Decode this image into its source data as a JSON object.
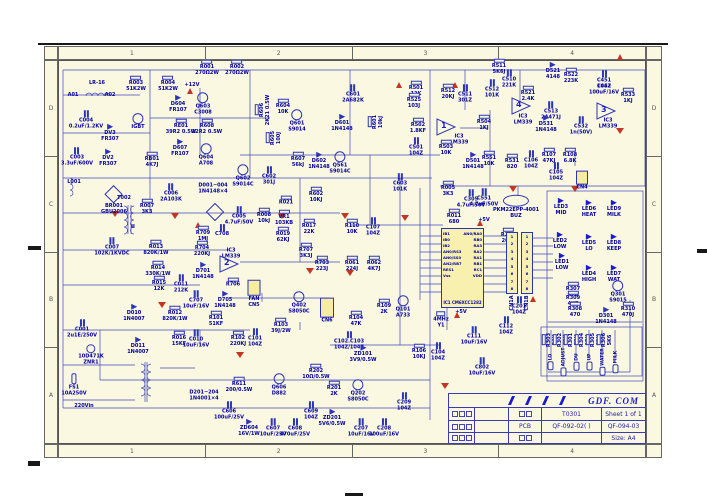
{
  "colors": {
    "paper": "#fbf8e1",
    "wire": "#2b35b8",
    "label": "#0000a0",
    "red": "#c43524",
    "ic_fill": "#f8f0ae"
  },
  "border": {
    "cols": [
      "1",
      "2",
      "3",
      "4"
    ],
    "rows": [
      "D",
      "C",
      "B",
      "A"
    ]
  },
  "title_block": {
    "company": "GDF. COM",
    "doc": "T0301",
    "sheet": "Sheet 1 of 1",
    "pcb": "PCB",
    "code1": "QF-092-02(  )",
    "code2": "QF-094-03",
    "size": "Size:  A4"
  },
  "ic1": {
    "ref": "IC1",
    "part": "CM6XCC1282",
    "left": [
      "IB1",
      "IB0",
      "IB2",
      "AN0/RS3",
      "AN0/SS0",
      "AN2/RB7",
      "RES1",
      "Vss"
    ],
    "right": [
      "AN0/RA0",
      "RB0",
      "RA3",
      "RA2",
      "RA1",
      "RB1",
      "RC1",
      "VDD"
    ]
  },
  "cn1": {
    "a": "CN1A",
    "b": "CN1B",
    "pins": [
      "1",
      "2",
      "3",
      "4",
      "5",
      "6",
      "7",
      "8"
    ]
  },
  "comparators": [
    {
      "n": "1",
      "x": 446,
      "y": 129
    },
    {
      "n": "4",
      "x": 521,
      "y": 108
    },
    {
      "n": "3",
      "x": 606,
      "y": 113
    },
    {
      "n": "2",
      "x": 229,
      "y": 266
    }
  ],
  "buttons": [
    {
      "label": "LO",
      "x": 551
    },
    {
      "label": "ADJUST",
      "x": 564
    },
    {
      "label": "DU",
      "x": 577
    },
    {
      "label": "UP",
      "x": 590
    },
    {
      "label": "WATER",
      "x": 603
    },
    {
      "label": "MILK",
      "x": 616
    }
  ],
  "buttons_y": 362,
  "grounds": [
    [
      115,
      211
    ],
    [
      175,
      213
    ],
    [
      345,
      213
    ],
    [
      405,
      215
    ],
    [
      513,
      186
    ],
    [
      575,
      186
    ],
    [
      620,
      128
    ],
    [
      350,
      270
    ],
    [
      162,
      302
    ],
    [
      240,
      352
    ],
    [
      310,
      268
    ],
    [
      445,
      383
    ],
    [
      282,
      213
    ]
  ],
  "powers": [
    [
      190,
      94
    ],
    [
      399,
      88
    ],
    [
      455,
      88
    ],
    [
      620,
      60
    ],
    [
      480,
      226
    ],
    [
      457,
      318
    ],
    [
      533,
      302
    ],
    [
      198,
      228
    ]
  ],
  "components": [
    {
      "r": "LR-16",
      "x": 97,
      "y": 84,
      "s": "txt"
    },
    {
      "r": "A01",
      "x": 73,
      "y": 96,
      "s": "txt"
    },
    {
      "r": "A02",
      "x": 110,
      "y": 96,
      "s": "txt"
    },
    {
      "r": "C004",
      "v": "0.2uF/1.2KV",
      "x": 86,
      "y": 120,
      "s": "cap"
    },
    {
      "r": "C003",
      "v": "3.3uF/600V",
      "x": 77,
      "y": 157,
      "s": "cap"
    },
    {
      "r": "IGBT",
      "x": 138,
      "y": 122,
      "s": "tr"
    },
    {
      "r": "DV3",
      "v": "FR307",
      "x": 110,
      "y": 133,
      "s": "dio"
    },
    {
      "r": "DV2",
      "v": "FR307",
      "x": 108,
      "y": 158,
      "s": "dio"
    },
    {
      "r": "RB01",
      "v": "4K7J",
      "x": 152,
      "y": 160,
      "s": "res"
    },
    {
      "r": "R003",
      "v": "51K2W",
      "x": 136,
      "y": 84,
      "s": "res"
    },
    {
      "r": "R004",
      "v": "51K2W",
      "x": 168,
      "y": 84,
      "s": "res"
    },
    {
      "r": "R001",
      "v": "270Ω2W",
      "x": 207,
      "y": 68,
      "s": "res"
    },
    {
      "r": "R002",
      "v": "270Ω2W",
      "x": 237,
      "y": 68,
      "s": "res"
    },
    {
      "r": "D604",
      "v": "FR107",
      "x": 178,
      "y": 104,
      "s": "dio"
    },
    {
      "r": "Q603",
      "v": "C3008",
      "x": 203,
      "y": 104,
      "s": "tr"
    },
    {
      "r": "RE01",
      "v": "39R2 0.5W",
      "x": 181,
      "y": 127,
      "s": "res"
    },
    {
      "r": "R608",
      "v": "22R2 0.5W",
      "x": 207,
      "y": 127,
      "s": "res"
    },
    {
      "r": "D607",
      "v": "FR107",
      "x": 180,
      "y": 148,
      "s": "dio"
    },
    {
      "r": "Q604",
      "v": "A708",
      "x": 206,
      "y": 155,
      "s": "tr"
    },
    {
      "r": "R606",
      "v": "2K21 0.5W",
      "x": 263,
      "y": 110,
      "s": "res",
      "rot": 1
    },
    {
      "r": "R605",
      "v": "100J",
      "x": 274,
      "y": 138,
      "s": "res",
      "rot": 1
    },
    {
      "r": "+12V",
      "x": 192,
      "y": 86,
      "s": "txt"
    },
    {
      "r": "Q602",
      "v": "S9014C",
      "x": 243,
      "y": 176,
      "s": "tr"
    },
    {
      "r": "C602",
      "v": "301J",
      "x": 269,
      "y": 176,
      "s": "cap"
    },
    {
      "r": "C601",
      "v": "2A682K",
      "x": 353,
      "y": 94,
      "s": "cap"
    },
    {
      "r": "R604",
      "v": "10K",
      "x": 283,
      "y": 107,
      "s": "res"
    },
    {
      "r": "Q601",
      "v": "S9014",
      "x": 297,
      "y": 121,
      "s": "tr"
    },
    {
      "r": "D601",
      "v": "1N4148",
      "x": 342,
      "y": 123,
      "s": "dio"
    },
    {
      "r": "R601",
      "v": "10kJ",
      "x": 376,
      "y": 122,
      "s": "res",
      "rot": 1
    },
    {
      "r": "R607",
      "v": "56kJ",
      "x": 298,
      "y": 160,
      "s": "res"
    },
    {
      "r": "D602",
      "v": "1N4148",
      "x": 319,
      "y": 161,
      "s": "dio"
    },
    {
      "r": "Q561",
      "v": "S9014C",
      "x": 340,
      "y": 163,
      "s": "tr"
    },
    {
      "r": "R501",
      "v": "12K",
      "x": 416,
      "y": 89,
      "s": "res"
    },
    {
      "r": "R525",
      "v": "103J",
      "x": 414,
      "y": 101,
      "s": "res"
    },
    {
      "r": "R512",
      "v": "20KJ",
      "x": 448,
      "y": 92,
      "s": "res"
    },
    {
      "r": "C511",
      "v": "301Z",
      "x": 465,
      "y": 94,
      "s": "cap"
    },
    {
      "r": "R502",
      "v": "1.8KF",
      "x": 418,
      "y": 126,
      "s": "res"
    },
    {
      "r": "IC3",
      "v": "LM339",
      "x": 459,
      "y": 140,
      "s": "txt"
    },
    {
      "r": "R504",
      "v": "1KJ",
      "x": 484,
      "y": 123,
      "s": "res"
    },
    {
      "r": "C501",
      "v": "104Z",
      "x": 416,
      "y": 147,
      "s": "cap"
    },
    {
      "r": "R503",
      "v": "10K",
      "x": 446,
      "y": 148,
      "s": "res"
    },
    {
      "r": "D501",
      "v": "1N4148",
      "x": 473,
      "y": 161,
      "s": "dio"
    },
    {
      "r": "R511",
      "v": "5K6J",
      "x": 499,
      "y": 67,
      "s": "res"
    },
    {
      "r": "C510",
      "v": "221K",
      "x": 509,
      "y": 79,
      "s": "cap"
    },
    {
      "r": "C512",
      "v": "101K",
      "x": 492,
      "y": 89,
      "s": "cap"
    },
    {
      "r": "D521",
      "v": "4148",
      "x": 553,
      "y": 71,
      "s": "dio"
    },
    {
      "r": "R522",
      "v": "223K",
      "x": 571,
      "y": 76,
      "s": "res"
    },
    {
      "r": "R521",
      "v": "2.4K",
      "x": 528,
      "y": 94,
      "s": "res"
    },
    {
      "r": "C451",
      "v": "104Z",
      "x": 604,
      "y": 80,
      "s": "cap"
    },
    {
      "r": "C452",
      "v": "100uF/16V",
      "x": 604,
      "y": 90,
      "s": "txt"
    },
    {
      "r": "R533",
      "v": "1KJ",
      "x": 628,
      "y": 96,
      "s": "res"
    },
    {
      "r": "IC3",
      "v": "LM339",
      "x": 523,
      "y": 120,
      "s": "txt"
    },
    {
      "r": "C513",
      "v": "2A471J",
      "x": 551,
      "y": 111,
      "s": "cap"
    },
    {
      "r": "D531",
      "v": "1N4148",
      "x": 546,
      "y": 124,
      "s": "dio"
    },
    {
      "r": "C532",
      "v": "1n(50V)",
      "x": 581,
      "y": 126,
      "s": "cap"
    },
    {
      "r": "IC3",
      "v": "LM339",
      "x": 608,
      "y": 124,
      "s": "txt"
    },
    {
      "r": "R551",
      "v": "10K",
      "x": 489,
      "y": 159,
      "s": "res"
    },
    {
      "r": "R531",
      "v": "820",
      "x": 512,
      "y": 162,
      "s": "res"
    },
    {
      "r": "C106",
      "v": "104Z",
      "x": 531,
      "y": 160,
      "s": "cap"
    },
    {
      "r": "R107",
      "v": "47KJ",
      "x": 549,
      "y": 156,
      "s": "res"
    },
    {
      "r": "R108",
      "v": "6.8K",
      "x": 570,
      "y": 156,
      "s": "res"
    },
    {
      "r": "C105",
      "v": "104Z",
      "x": 556,
      "y": 172,
      "s": "cap"
    },
    {
      "r": "CN4",
      "x": 582,
      "y": 181,
      "s": "con",
      "w": 12,
      "h": 14
    },
    {
      "r": "C551",
      "v": "4.7uF/50V",
      "x": 484,
      "y": 198,
      "s": "cap"
    },
    {
      "r": "PKM22EPP-4001",
      "v": "BUZ",
      "x": 516,
      "y": 207,
      "s": "buz"
    },
    {
      "r": "L001",
      "x": 74,
      "y": 183,
      "s": "txt"
    },
    {
      "r": "BR001",
      "v": "GBU2006",
      "x": 114,
      "y": 200,
      "s": "brg"
    },
    {
      "r": "T002",
      "x": 124,
      "y": 199,
      "s": "txt"
    },
    {
      "r": "II",
      "x": 133,
      "y": 228,
      "s": "txt"
    },
    {
      "r": "C006",
      "v": "2A103K",
      "x": 171,
      "y": 193,
      "s": "cap"
    },
    {
      "r": "R007",
      "v": "3K3",
      "x": 147,
      "y": 207,
      "s": "res"
    },
    {
      "r": "D001~004",
      "v": "1N4148×4",
      "x": 213,
      "y": 189,
      "s": "txt"
    },
    {
      "r": "",
      "x": 215,
      "y": 212,
      "s": "brg"
    },
    {
      "r": "C005",
      "v": "4.7uF/50V",
      "x": 239,
      "y": 216,
      "s": "cap"
    },
    {
      "r": "R008",
      "v": "10kJ",
      "x": 264,
      "y": 216,
      "s": "res"
    },
    {
      "r": "C007",
      "v": "102K/1KVDC",
      "x": 112,
      "y": 247,
      "s": "cap"
    },
    {
      "r": "R013",
      "v": "820K/1W",
      "x": 156,
      "y": 248,
      "s": "res"
    },
    {
      "r": "R014",
      "v": "330K/1W",
      "x": 158,
      "y": 269,
      "s": "res"
    },
    {
      "r": "R015",
      "v": "12K",
      "x": 159,
      "y": 284,
      "s": "res"
    },
    {
      "r": "R709",
      "v": "1MJ",
      "x": 203,
      "y": 234,
      "s": "res"
    },
    {
      "r": "R704",
      "v": "220KJ",
      "x": 202,
      "y": 249,
      "s": "res"
    },
    {
      "r": "C708",
      "x": 222,
      "y": 231,
      "s": "cap"
    },
    {
      "r": "IC3",
      "v": "LM339",
      "x": 231,
      "y": 254,
      "s": "txt"
    },
    {
      "r": "D701",
      "v": "1N4148",
      "x": 203,
      "y": 271,
      "s": "dio"
    },
    {
      "r": "C011",
      "v": "212K",
      "x": 181,
      "y": 284,
      "s": "cap"
    },
    {
      "r": "C707",
      "v": "10uF/16V",
      "x": 196,
      "y": 300,
      "s": "cap"
    },
    {
      "r": "D705",
      "v": "1N4148",
      "x": 225,
      "y": 300,
      "s": "dio"
    },
    {
      "r": "R706",
      "x": 233,
      "y": 283,
      "s": "res"
    },
    {
      "r": "R021",
      "x": 286,
      "y": 201,
      "s": "res"
    },
    {
      "r": "VR1",
      "v": "103KB",
      "x": 284,
      "y": 218,
      "s": "pot"
    },
    {
      "r": "R019",
      "v": "62KJ",
      "x": 283,
      "y": 235,
      "s": "res"
    },
    {
      "r": "R602",
      "v": "10KJ",
      "x": 316,
      "y": 195,
      "s": "res"
    },
    {
      "r": "R017",
      "v": "22K",
      "x": 309,
      "y": 227,
      "s": "res"
    },
    {
      "r": "R707",
      "v": "3K3J",
      "x": 306,
      "y": 251,
      "s": "res"
    },
    {
      "r": "R703",
      "v": "223J",
      "x": 322,
      "y": 264,
      "s": "res"
    },
    {
      "r": "R061",
      "v": "224J",
      "x": 352,
      "y": 264,
      "s": "res"
    },
    {
      "r": "R062",
      "v": "4K7J",
      "x": 374,
      "y": 264,
      "s": "res"
    },
    {
      "r": "R110",
      "v": "10K",
      "x": 352,
      "y": 227,
      "s": "res"
    },
    {
      "r": "C107",
      "v": "104Z",
      "x": 373,
      "y": 227,
      "s": "cap"
    },
    {
      "r": "C603",
      "v": "101K",
      "x": 400,
      "y": 183,
      "s": "cap"
    },
    {
      "r": "R005",
      "v": "3K3",
      "x": 448,
      "y": 189,
      "s": "res"
    },
    {
      "r": "R011",
      "v": "680",
      "x": 454,
      "y": 217,
      "s": "res"
    },
    {
      "r": "C305",
      "v": "4.7uF/50V",
      "x": 471,
      "y": 199,
      "s": "cap"
    },
    {
      "r": "R206",
      "v": "20KJ",
      "x": 508,
      "y": 236,
      "s": "res"
    },
    {
      "r": "4MHz",
      "v": "Y1",
      "x": 441,
      "y": 320,
      "s": "xtl"
    },
    {
      "r": "C111",
      "v": "10uF/16V",
      "x": 474,
      "y": 336,
      "s": "cap"
    },
    {
      "r": "C112",
      "v": "104Z",
      "x": 506,
      "y": 326,
      "s": "cap"
    },
    {
      "r": "C802",
      "v": "10uF/16V",
      "x": 482,
      "y": 367,
      "s": "cap"
    },
    {
      "r": "+5V",
      "x": 484,
      "y": 221,
      "s": "txt"
    },
    {
      "r": "+5V",
      "x": 461,
      "y": 313,
      "s": "txt"
    },
    {
      "r": "C001",
      "v": "2u1E/250V",
      "x": 82,
      "y": 329,
      "s": "cap"
    },
    {
      "r": "10D471K",
      "v": "ZNR1",
      "x": 91,
      "y": 355,
      "s": "zn2"
    },
    {
      "r": "FS1",
      "v": "10A250V",
      "x": 74,
      "y": 385,
      "s": "fus"
    },
    {
      "r": "220Vin",
      "x": 84,
      "y": 407,
      "s": "txt"
    },
    {
      "r": "D010",
      "v": "1N4007",
      "x": 134,
      "y": 313,
      "s": "dio"
    },
    {
      "r": "D011",
      "v": "1N4007",
      "x": 138,
      "y": 346,
      "s": "dio"
    },
    {
      "r": "R012",
      "v": "820K/1W",
      "x": 175,
      "y": 314,
      "s": "res"
    },
    {
      "r": "R016",
      "v": "15KF",
      "x": 179,
      "y": 339,
      "s": "res"
    },
    {
      "r": "C010",
      "v": "10uF/16V",
      "x": 196,
      "y": 339,
      "s": "cap"
    },
    {
      "r": "R101",
      "v": "51KF",
      "x": 216,
      "y": 319,
      "s": "res"
    },
    {
      "r": "R102",
      "v": "220KJ",
      "x": 238,
      "y": 339,
      "s": "res"
    },
    {
      "r": "C101",
      "v": "104Z",
      "x": 255,
      "y": 338,
      "s": "cap"
    },
    {
      "r": "FAN",
      "v": "CN5",
      "x": 254,
      "y": 294,
      "s": "con",
      "w": 13,
      "h": 16
    },
    {
      "r": "Q402",
      "v": "S8050C",
      "x": 299,
      "y": 303,
      "s": "tr"
    },
    {
      "r": "R103",
      "v": "39J/2W",
      "x": 281,
      "y": 326,
      "s": "res"
    },
    {
      "r": "CN6",
      "x": 327,
      "y": 311,
      "s": "con",
      "w": 14,
      "h": 20
    },
    {
      "r": "D201~204",
      "v": "1N4001×4",
      "x": 204,
      "y": 396,
      "s": "txt"
    },
    {
      "r": "R611",
      "v": "200/0.5W",
      "x": 239,
      "y": 385,
      "s": "res"
    },
    {
      "r": "Q606",
      "v": "D882",
      "x": 279,
      "y": 385,
      "s": "tr"
    },
    {
      "r": "C606",
      "v": "100uF/25V",
      "x": 229,
      "y": 411,
      "s": "cap"
    },
    {
      "r": "ZD604",
      "v": "16V/1W",
      "x": 249,
      "y": 428,
      "s": "zen"
    },
    {
      "r": "C607",
      "v": "10uF/25V",
      "x": 273,
      "y": 428,
      "s": "cap"
    },
    {
      "r": "C608",
      "v": "470uF/25V",
      "x": 295,
      "y": 428,
      "s": "cap"
    },
    {
      "r": "C609",
      "v": "104Z",
      "x": 311,
      "y": 411,
      "s": "cap"
    },
    {
      "r": "R202",
      "v": "10Ω/0.5W",
      "x": 316,
      "y": 372,
      "s": "res"
    },
    {
      "r": "R201",
      "v": "2K",
      "x": 334,
      "y": 389,
      "s": "res"
    },
    {
      "r": "Q202",
      "v": "S8050C",
      "x": 358,
      "y": 391,
      "s": "tr"
    },
    {
      "r": "ZD201",
      "v": "5V6/0.5W",
      "x": 332,
      "y": 418,
      "s": "zen"
    },
    {
      "r": "C207",
      "v": "10uF/16V",
      "x": 361,
      "y": 428,
      "s": "cap"
    },
    {
      "r": "C208",
      "v": "100uF/16V",
      "x": 384,
      "y": 428,
      "s": "cap"
    },
    {
      "r": "C209",
      "v": "104Z",
      "x": 404,
      "y": 402,
      "s": "cap"
    },
    {
      "r": "R104",
      "v": "47K",
      "x": 356,
      "y": 319,
      "s": "res"
    },
    {
      "r": "R109",
      "v": "2K",
      "x": 384,
      "y": 307,
      "s": "res"
    },
    {
      "r": "Q101",
      "v": "A733",
      "x": 403,
      "y": 307,
      "s": "tr"
    },
    {
      "r": "C102.C103",
      "v": "104Z/104Z",
      "x": 349,
      "y": 341,
      "s": "cap"
    },
    {
      "r": "ZD101",
      "v": "3V9/0.5W",
      "x": 363,
      "y": 354,
      "s": "zen"
    },
    {
      "r": "R106",
      "v": "10KJ",
      "x": 419,
      "y": 352,
      "s": "res"
    },
    {
      "r": "C104",
      "v": "104Z",
      "x": 438,
      "y": 352,
      "s": "cap"
    },
    {
      "r": "LED3",
      "v": "MID",
      "x": 561,
      "y": 207,
      "s": "led"
    },
    {
      "r": "LED6",
      "v": "HEAT",
      "x": 589,
      "y": 209,
      "s": "led"
    },
    {
      "r": "LED9",
      "v": "MILK",
      "x": 614,
      "y": 209,
      "s": "led"
    },
    {
      "r": "LED2",
      "v": "LOW",
      "x": 560,
      "y": 241,
      "s": "led"
    },
    {
      "r": "LED5",
      "v": "LO",
      "x": 589,
      "y": 243,
      "s": "led"
    },
    {
      "r": "LED8",
      "v": "KEEP",
      "x": 614,
      "y": 243,
      "s": "led"
    },
    {
      "r": "LED1",
      "v": "LOW",
      "x": 562,
      "y": 262,
      "s": "led"
    },
    {
      "r": "LED4",
      "v": "HIGH",
      "x": 589,
      "y": 274,
      "s": "led"
    },
    {
      "r": "LED7",
      "v": "WAT",
      "x": 614,
      "y": 274,
      "s": "led"
    },
    {
      "r": "R307",
      "v": "470",
      "x": 573,
      "y": 290,
      "s": "res"
    },
    {
      "r": "R309",
      "v": "4K7",
      "x": 573,
      "y": 299,
      "s": "res"
    },
    {
      "r": "R308",
      "v": "470",
      "x": 575,
      "y": 310,
      "s": "res"
    },
    {
      "r": "Q301",
      "v": "S9015",
      "x": 618,
      "y": 292,
      "s": "tr"
    },
    {
      "r": "R310",
      "v": "470J",
      "x": 628,
      "y": 310,
      "s": "res"
    },
    {
      "r": "D301",
      "v": "1N4148",
      "x": 606,
      "y": 316,
      "s": "dio"
    },
    {
      "r": "C201",
      "v": "104Z",
      "x": 519,
      "y": 306,
      "s": "cap"
    },
    {
      "r": "R303",
      "v": "56K",
      "x": 550,
      "y": 340,
      "s": "res",
      "rot": 1
    },
    {
      "r": "R302",
      "v": "62K",
      "x": 561,
      "y": 340,
      "s": "res",
      "rot": 1
    },
    {
      "r": "R301",
      "v": "75K",
      "x": 572,
      "y": 340,
      "s": "res",
      "rot": 1
    },
    {
      "r": "R304",
      "v": "15K",
      "x": 583,
      "y": 340,
      "s": "res",
      "rot": 1
    },
    {
      "r": "R305",
      "v": "82K",
      "x": 594,
      "y": 340,
      "s": "res",
      "rot": 1
    },
    {
      "r": "R306",
      "v": "5K6",
      "x": 605,
      "y": 340,
      "s": "res",
      "rot": 1
    }
  ]
}
